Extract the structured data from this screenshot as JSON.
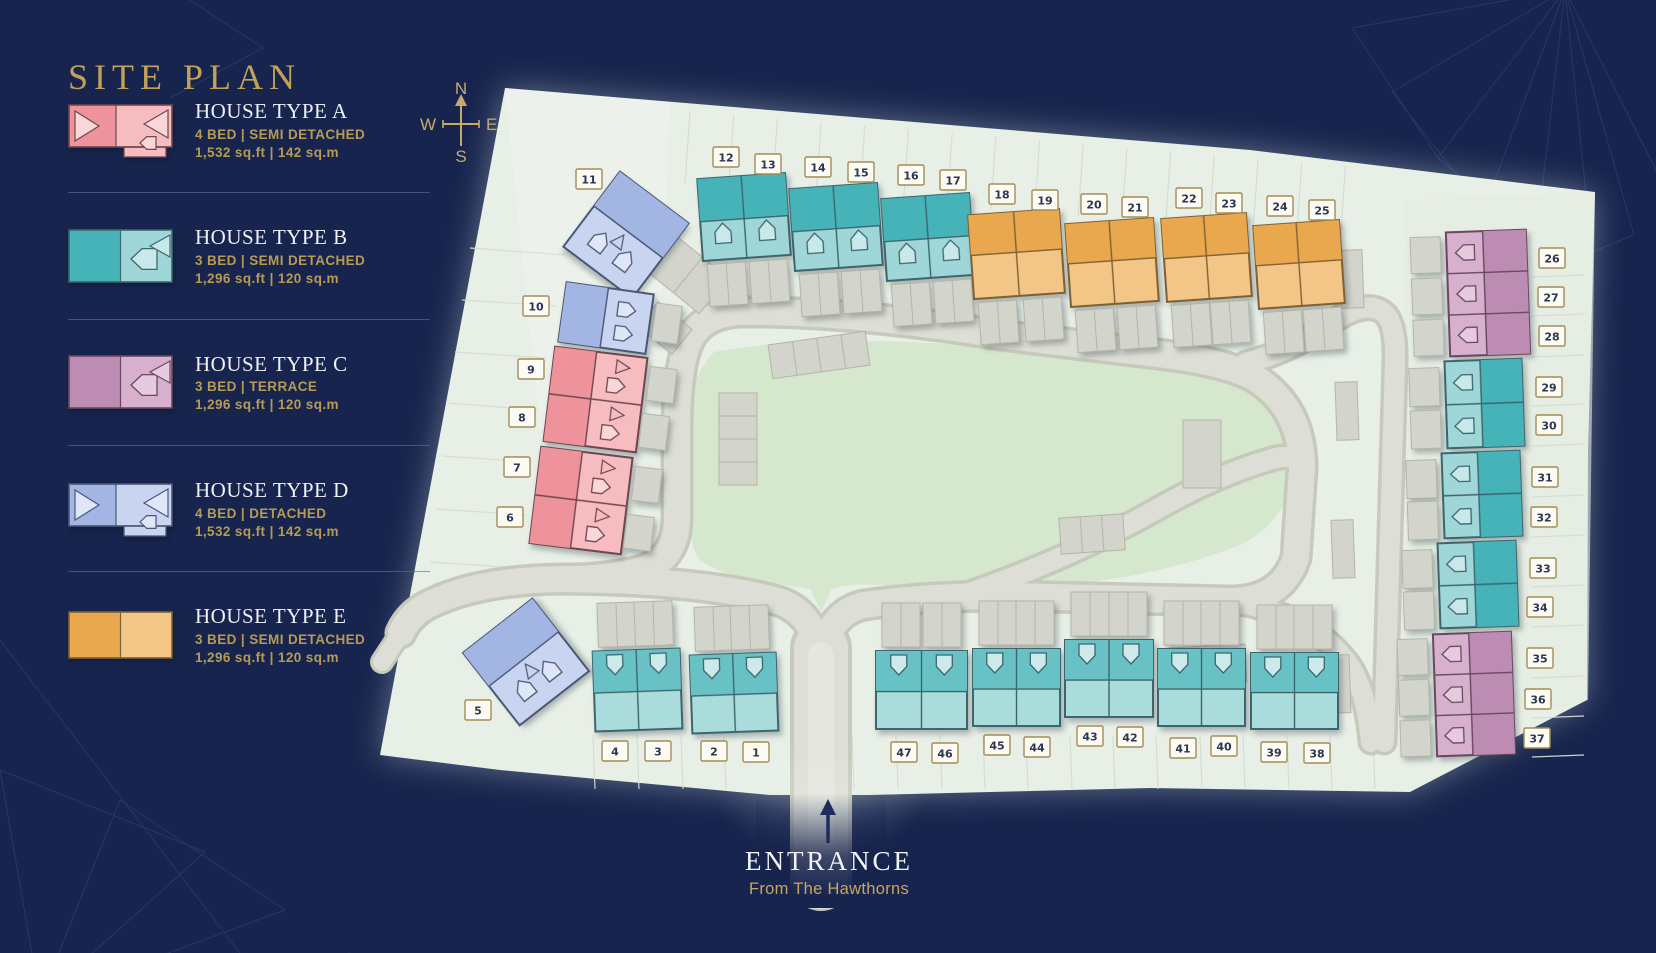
{
  "title": "SITE PLAN",
  "compass": {
    "n": "N",
    "e": "E",
    "s": "S",
    "w": "W"
  },
  "legend": [
    {
      "type": "A",
      "title": "HOUSE TYPE A",
      "spec": "4 BED | SEMI DETACHED",
      "area": "1,532 sq.ft | 142 sq.m"
    },
    {
      "type": "B",
      "title": "HOUSE TYPE B",
      "spec": "3 BED | SEMI DETACHED",
      "area": "1,296 sq.ft | 120 sq.m"
    },
    {
      "type": "C",
      "title": "HOUSE TYPE C",
      "spec": "3 BED | TERRACE",
      "area": "1,296 sq.ft | 120 sq.m"
    },
    {
      "type": "D",
      "title": "HOUSE TYPE D",
      "spec": "4 BED | DETACHED",
      "area": "1,532 sq.ft | 142 sq.m"
    },
    {
      "type": "E",
      "title": "HOUSE TYPE E",
      "spec": "3 BED | SEMI DETACHED",
      "area": "1,296 sq.ft | 120 sq.m"
    }
  ],
  "entrance": {
    "title": "ENTRANCE",
    "subtitle": "From The Hawthorns"
  },
  "palette": {
    "navy": "#17244e",
    "gold": "#c3a258",
    "ground": "#e8efe7",
    "green": "#d5e7cd",
    "road_casing": "#c7c9bc",
    "road_fill": "#dddfd6",
    "road_center": "#e5e6de",
    "parcel": "#d6ddd2",
    "garage": {
      "fill": "#d3d4cb",
      "stroke": "#b4b5aa"
    },
    "label": {
      "fill": "#fbfbf3",
      "stroke": "#a38c54",
      "text": "#2c3552"
    },
    "types": {
      "A": {
        "dark": "#ee929b",
        "light": "#f6bcc0",
        "glyph": "#f9d7d9",
        "stroke": "#6d474e"
      },
      "B": {
        "dark": "#45b3b7",
        "light": "#9fd7d8",
        "glyph": "#c8e8e9",
        "stroke": "#3d656e"
      },
      "B2": {
        "dark": "#68c2c5",
        "light": "#abdcdc",
        "glyph": "#cdeaea",
        "stroke": "#3d656e"
      },
      "C": {
        "dark": "#bc8cb3",
        "light": "#d6b0cd",
        "glyph": "#e6cbdf",
        "stroke": "#69475f"
      },
      "D": {
        "dark": "#a2b5e3",
        "light": "#c9d5f0",
        "glyph": "#dfe6f7",
        "stroke": "#4a5878"
      },
      "E": {
        "dark": "#e9a74e",
        "light": "#f3c586",
        "glyph": "#f7d8ab",
        "stroke": "#7d6135"
      }
    }
  },
  "site": {
    "plots": [
      {
        "n": "1",
        "type": "B",
        "x": 756,
        "y": 752
      },
      {
        "n": "2",
        "type": "B",
        "x": 714,
        "y": 751
      },
      {
        "n": "3",
        "type": "B",
        "x": 658,
        "y": 751
      },
      {
        "n": "4",
        "type": "B",
        "x": 615,
        "y": 751
      },
      {
        "n": "5",
        "type": "D",
        "x": 478,
        "y": 710
      },
      {
        "n": "6",
        "type": "A",
        "x": 510,
        "y": 517
      },
      {
        "n": "7",
        "type": "A",
        "x": 517,
        "y": 467
      },
      {
        "n": "8",
        "type": "A",
        "x": 522,
        "y": 417
      },
      {
        "n": "9",
        "type": "A",
        "x": 531,
        "y": 369
      },
      {
        "n": "10",
        "type": "D",
        "x": 536,
        "y": 306
      },
      {
        "n": "11",
        "type": "D",
        "x": 589,
        "y": 179
      },
      {
        "n": "12",
        "type": "B",
        "x": 726,
        "y": 157
      },
      {
        "n": "13",
        "type": "B",
        "x": 768,
        "y": 164
      },
      {
        "n": "14",
        "type": "B",
        "x": 818,
        "y": 167
      },
      {
        "n": "15",
        "type": "B",
        "x": 861,
        "y": 172
      },
      {
        "n": "16",
        "type": "B",
        "x": 911,
        "y": 175
      },
      {
        "n": "17",
        "type": "B",
        "x": 953,
        "y": 180
      },
      {
        "n": "18",
        "type": "E",
        "x": 1002,
        "y": 194
      },
      {
        "n": "19",
        "type": "E",
        "x": 1045,
        "y": 200
      },
      {
        "n": "20",
        "type": "E",
        "x": 1094,
        "y": 204
      },
      {
        "n": "21",
        "type": "E",
        "x": 1135,
        "y": 207
      },
      {
        "n": "22",
        "type": "E",
        "x": 1189,
        "y": 198
      },
      {
        "n": "23",
        "type": "E",
        "x": 1229,
        "y": 203
      },
      {
        "n": "24",
        "type": "E",
        "x": 1280,
        "y": 206
      },
      {
        "n": "25",
        "type": "E",
        "x": 1322,
        "y": 210
      },
      {
        "n": "26",
        "type": "C",
        "x": 1552,
        "y": 258
      },
      {
        "n": "27",
        "type": "C",
        "x": 1551,
        "y": 297
      },
      {
        "n": "28",
        "type": "C",
        "x": 1552,
        "y": 336
      },
      {
        "n": "29",
        "type": "B",
        "x": 1549,
        "y": 387
      },
      {
        "n": "30",
        "type": "B",
        "x": 1549,
        "y": 425
      },
      {
        "n": "31",
        "type": "B",
        "x": 1545,
        "y": 477
      },
      {
        "n": "32",
        "type": "B",
        "x": 1544,
        "y": 517
      },
      {
        "n": "33",
        "type": "B",
        "x": 1543,
        "y": 568
      },
      {
        "n": "34",
        "type": "B",
        "x": 1540,
        "y": 607
      },
      {
        "n": "35",
        "type": "C",
        "x": 1540,
        "y": 658
      },
      {
        "n": "36",
        "type": "C",
        "x": 1538,
        "y": 699
      },
      {
        "n": "37",
        "type": "C",
        "x": 1537,
        "y": 738
      },
      {
        "n": "38",
        "type": "B",
        "x": 1317,
        "y": 753
      },
      {
        "n": "39",
        "type": "B",
        "x": 1274,
        "y": 752
      },
      {
        "n": "40",
        "type": "B",
        "x": 1224,
        "y": 746
      },
      {
        "n": "41",
        "type": "B",
        "x": 1183,
        "y": 748
      },
      {
        "n": "42",
        "type": "B",
        "x": 1130,
        "y": 737
      },
      {
        "n": "43",
        "type": "B",
        "x": 1090,
        "y": 736
      },
      {
        "n": "44",
        "type": "B",
        "x": 1037,
        "y": 747
      },
      {
        "n": "45",
        "type": "B",
        "x": 997,
        "y": 745
      },
      {
        "n": "46",
        "type": "B",
        "x": 945,
        "y": 753
      },
      {
        "n": "47",
        "type": "B",
        "x": 904,
        "y": 752
      }
    ],
    "buildings": [
      {
        "variant": "blueV",
        "x": 583,
        "y": 188,
        "w": 86,
        "h": 94,
        "rot": 37,
        "plots": "11"
      },
      {
        "variant": "blueH",
        "x": 562,
        "y": 288,
        "w": 88,
        "h": 60,
        "rot": 8,
        "plots": "10"
      },
      {
        "variant": "pinkLeft",
        "x": 549,
        "y": 352,
        "w": 93,
        "h": 95,
        "rot": 7,
        "plots": "9,8"
      },
      {
        "variant": "pinkLeft",
        "x": 535,
        "y": 452,
        "w": 92,
        "h": 97,
        "rot": 7,
        "plots": "7,6"
      },
      {
        "variant": "blueV",
        "x": 482,
        "y": 616,
        "w": 88,
        "h": 92,
        "rot": -38,
        "plots": "5"
      },
      {
        "variant": "tealTop",
        "x": 700,
        "y": 176,
        "w": 88,
        "h": 82,
        "rot": -4,
        "plots": "12,13"
      },
      {
        "variant": "tealTop",
        "x": 792,
        "y": 186,
        "w": 88,
        "h": 82,
        "rot": -4,
        "plots": "14,15"
      },
      {
        "variant": "tealTop",
        "x": 884,
        "y": 196,
        "w": 88,
        "h": 82,
        "rot": -4,
        "plots": "16,17"
      },
      {
        "variant": "orange",
        "x": 971,
        "y": 212,
        "w": 91,
        "h": 84,
        "rot": -4,
        "plots": "18,19"
      },
      {
        "variant": "orange",
        "x": 1068,
        "y": 221,
        "w": 88,
        "h": 83,
        "rot": -4,
        "plots": "20,21"
      },
      {
        "variant": "orange",
        "x": 1164,
        "y": 216,
        "w": 85,
        "h": 83,
        "rot": -4,
        "plots": "22,23"
      },
      {
        "variant": "orange",
        "x": 1256,
        "y": 223,
        "w": 86,
        "h": 83,
        "rot": -4,
        "plots": "24,25"
      },
      {
        "variant": "purpleRight",
        "x": 1448,
        "y": 231,
        "w": 80,
        "h": 124,
        "rot": -2,
        "plots": "26,27,28"
      },
      {
        "variant": "tealRight",
        "x": 1446,
        "y": 360,
        "w": 77,
        "h": 87,
        "rot": -2,
        "plots": "29,30"
      },
      {
        "variant": "tealRight",
        "x": 1443,
        "y": 452,
        "w": 78,
        "h": 85,
        "rot": -2,
        "plots": "31,32"
      },
      {
        "variant": "tealRight",
        "x": 1439,
        "y": 542,
        "w": 78,
        "h": 85,
        "rot": -2,
        "plots": "33,34"
      },
      {
        "variant": "purpleRight",
        "x": 1435,
        "y": 633,
        "w": 78,
        "h": 122,
        "rot": -2,
        "plots": "35,36,37"
      },
      {
        "variant": "tealBottom",
        "x": 594,
        "y": 650,
        "w": 87,
        "h": 80,
        "rot": -2,
        "plots": "4,3"
      },
      {
        "variant": "tealBottom",
        "x": 691,
        "y": 654,
        "w": 86,
        "h": 78,
        "rot": -2,
        "plots": "2,1"
      },
      {
        "variant": "tealBottom",
        "x": 876,
        "y": 651,
        "w": 91,
        "h": 78,
        "rot": 0,
        "plots": "47,46"
      },
      {
        "variant": "tealBottom",
        "x": 973,
        "y": 649,
        "w": 87,
        "h": 77,
        "rot": 0,
        "plots": "45,44"
      },
      {
        "variant": "tealBottom",
        "x": 1065,
        "y": 640,
        "w": 88,
        "h": 77,
        "rot": 0,
        "plots": "43,42"
      },
      {
        "variant": "tealBottom",
        "x": 1158,
        "y": 649,
        "w": 87,
        "h": 77,
        "rot": 0,
        "plots": "41,40"
      },
      {
        "variant": "tealBottom",
        "x": 1251,
        "y": 653,
        "w": 87,
        "h": 76,
        "rot": 0,
        "plots": "39,38"
      }
    ],
    "parking": [
      [
        770,
        338,
        98,
        34,
        -8,
        4
      ],
      [
        692,
        420,
        92,
        38,
        90,
        4
      ],
      [
        1060,
        516,
        64,
        36,
        -4,
        3
      ],
      [
        1170,
        646,
        76,
        38,
        -3,
        3
      ],
      [
        1183,
        420,
        38,
        68,
        0,
        1
      ],
      [
        655,
        252,
        66,
        46,
        39,
        2
      ],
      [
        643,
        312,
        44,
        32,
        39,
        1
      ],
      [
        1341,
        250,
        22,
        58,
        -2,
        1
      ],
      [
        1336,
        382,
        22,
        58,
        -2,
        1
      ],
      [
        1332,
        520,
        22,
        58,
        -2,
        1
      ],
      [
        1328,
        655,
        22,
        58,
        -2,
        1
      ]
    ]
  }
}
